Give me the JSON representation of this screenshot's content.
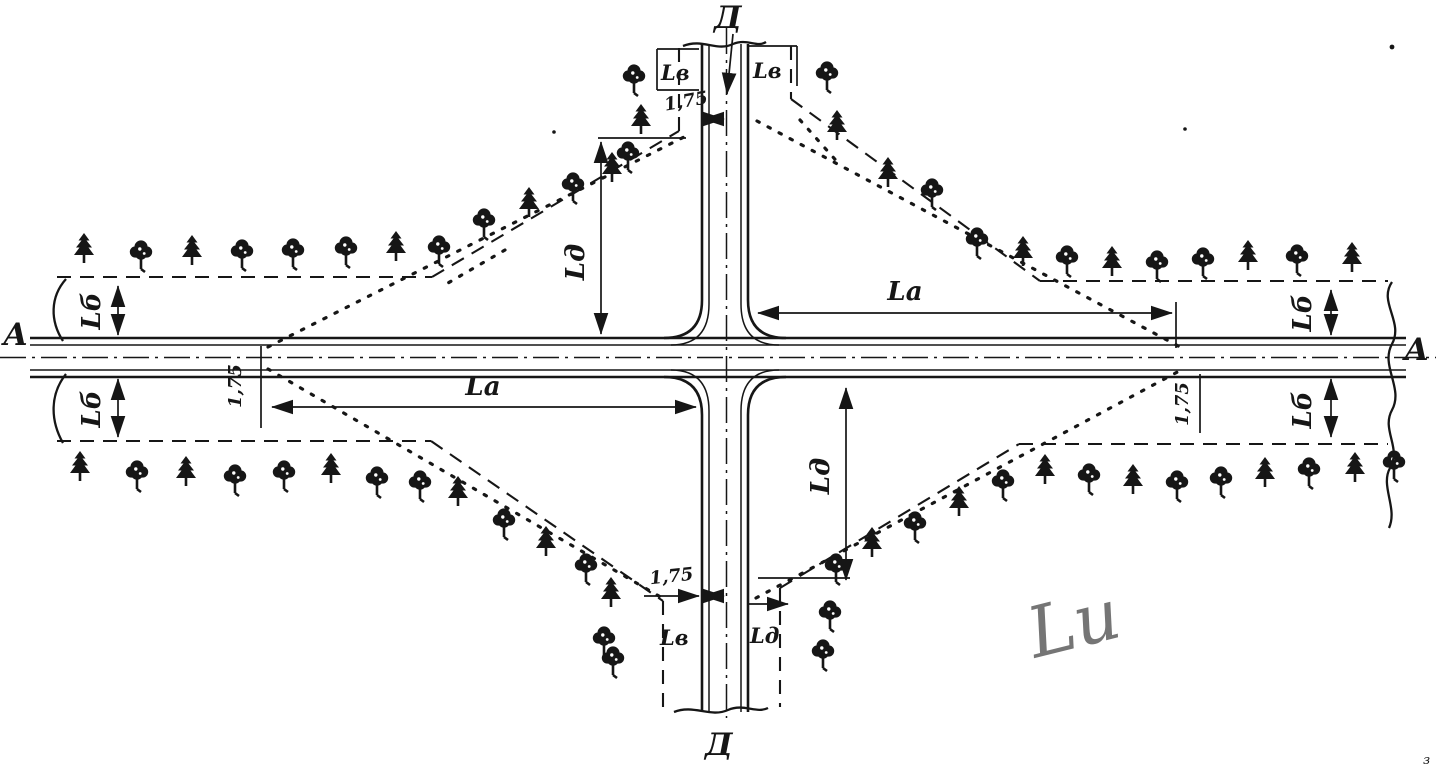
{
  "labels": {
    "section_top": "Д",
    "section_bottom": "Д",
    "section_left": "А",
    "section_right": "А"
  },
  "dimensions": {
    "la_right": "Lа",
    "la_left": "Lа",
    "lb_left_top": "Lб",
    "lb_left_bottom": "Lб",
    "lb_right_top": "Lб",
    "lb_right_bottom": "Lб",
    "ld_top": "Lд",
    "ld_bottom": "Lд",
    "lv_top_left": "Lв",
    "lv_top_right": "Lв",
    "lv_bottom_left": "Lв",
    "lv_bottom_right": "Lд",
    "offset_left": "1,75",
    "offset_right": "1,75",
    "offset_top": "1,75",
    "offset_bottom": "1,75"
  },
  "annotations": {
    "handwritten": "Lи",
    "corner_mark": "з"
  },
  "colors": {
    "ink": "#161616",
    "paper": "#ffffff",
    "pencil": "#5e5e5e"
  }
}
